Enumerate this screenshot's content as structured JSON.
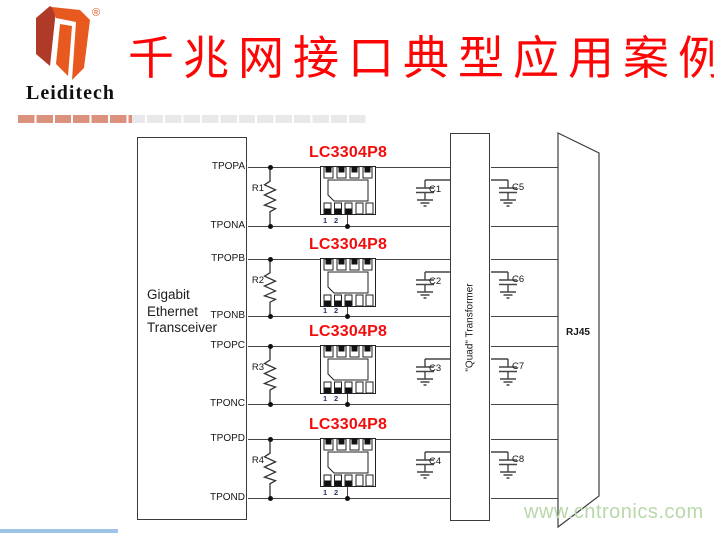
{
  "header": {
    "logo_text": "Leiditech",
    "registered_mark": "®",
    "title": "千兆网接口典型应用案例"
  },
  "schematic": {
    "transceiver": {
      "line1": "Gigabit",
      "line2": "Ethernet",
      "line3": "Transceiver"
    },
    "transformer_label": "\"Quad\" Transformer",
    "rj45_label": "RJ45",
    "channels": [
      {
        "top_pin": "TPOPA",
        "bottom_pin": "TPONA",
        "resistor": "R1",
        "ic_label": "LC3304P8",
        "pin1": "1",
        "pin2": "2",
        "left_cap": "C1",
        "right_cap": "C5"
      },
      {
        "top_pin": "TPOPB",
        "bottom_pin": "TPONB",
        "resistor": "R2",
        "ic_label": "LC3304P8",
        "pin1": "1",
        "pin2": "2",
        "left_cap": "C2",
        "right_cap": "C6"
      },
      {
        "top_pin": "TPOPC",
        "bottom_pin": "TPONC",
        "resistor": "R3",
        "ic_label": "LC3304P8",
        "pin1": "1",
        "pin2": "2",
        "left_cap": "C3",
        "right_cap": "C7"
      },
      {
        "top_pin": "TPOPD",
        "bottom_pin": "TPOND",
        "resistor": "R4",
        "ic_label": "LC3304P8",
        "pin1": "1",
        "pin2": "2",
        "left_cap": "C4",
        "right_cap": "C8"
      }
    ]
  },
  "watermark": "www.cntronics.com",
  "colors": {
    "title_red": "#fe0505",
    "ic_label_red": "#f20d0d",
    "logo_dark_red": "#b03a28",
    "logo_orange": "#e8591f",
    "watermark_green": "#b9d8aa",
    "bar_salmon": "#dc917f",
    "bar_gray": "#e9e9e9",
    "line_gray": "#454545"
  }
}
